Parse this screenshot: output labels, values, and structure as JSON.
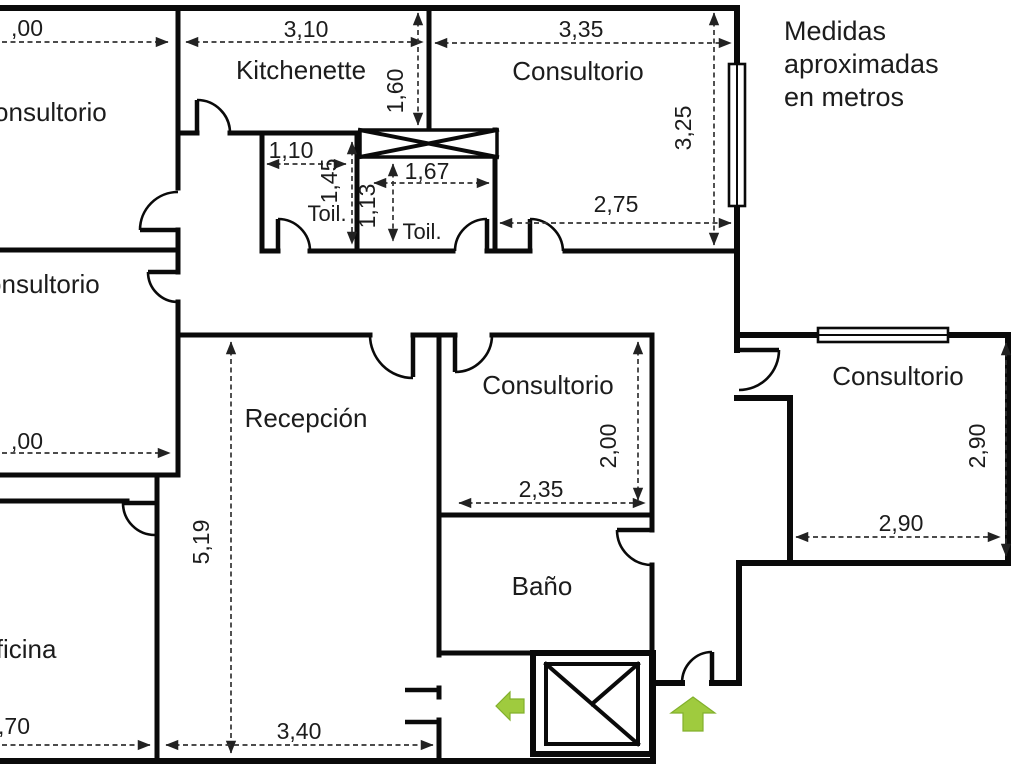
{
  "note": {
    "line1": "Medidas",
    "line2": "aproximadas",
    "line3": "en metros"
  },
  "rooms": {
    "consultorio_top_left": {
      "label": "Consultorio"
    },
    "kitchenette": {
      "label": "Kitchenette"
    },
    "consultorio_top_right": {
      "label": "Consultorio"
    },
    "toilet_left": {
      "label": "Toil."
    },
    "toilet_right": {
      "label": "Toil."
    },
    "consultorio_mid_left": {
      "label": "Consultorio"
    },
    "recepcion": {
      "label": "Recepción"
    },
    "consultorio_center": {
      "label": "Consultorio"
    },
    "consultorio_right": {
      "label": "Consultorio"
    },
    "bano": {
      "label": "Baño"
    },
    "oficina": {
      "label": "Oficina"
    }
  },
  "dimensions": {
    "c1_width": ",00",
    "kitchenette_width": "3,10",
    "ctr_width_top": "3,35",
    "kitchenette_depth": "1,60",
    "ctr_height": "3,25",
    "ctr_width_bottom": "2,75",
    "toil_left_width": "1,10",
    "toil_left_depth": "1,45",
    "toil_right_width": "1,67",
    "toil_right_depth": "1,13",
    "c2_width": ",00",
    "recepcion_height": "5,19",
    "recepcion_width": "3,40",
    "oficina_width": ",70",
    "cc_width": "2,35",
    "cc_height": "2,00",
    "cr_width": "2,90",
    "cr_height": "2,90"
  },
  "features": {
    "elevator": "elevator-shaft-symbol",
    "duct": "crossed-duct-symbol",
    "window_right": "window-symbol",
    "window_top_right_room": "window-symbol",
    "entrance_arrow": "green-up-arrow",
    "exit_arrow": "green-left-arrow"
  },
  "colors": {
    "background": "#ffffff",
    "wall": "#0a0a0a",
    "dim_line": "#333333",
    "text": "#1c1c1c",
    "arrow_green": "#9fcb3e"
  }
}
